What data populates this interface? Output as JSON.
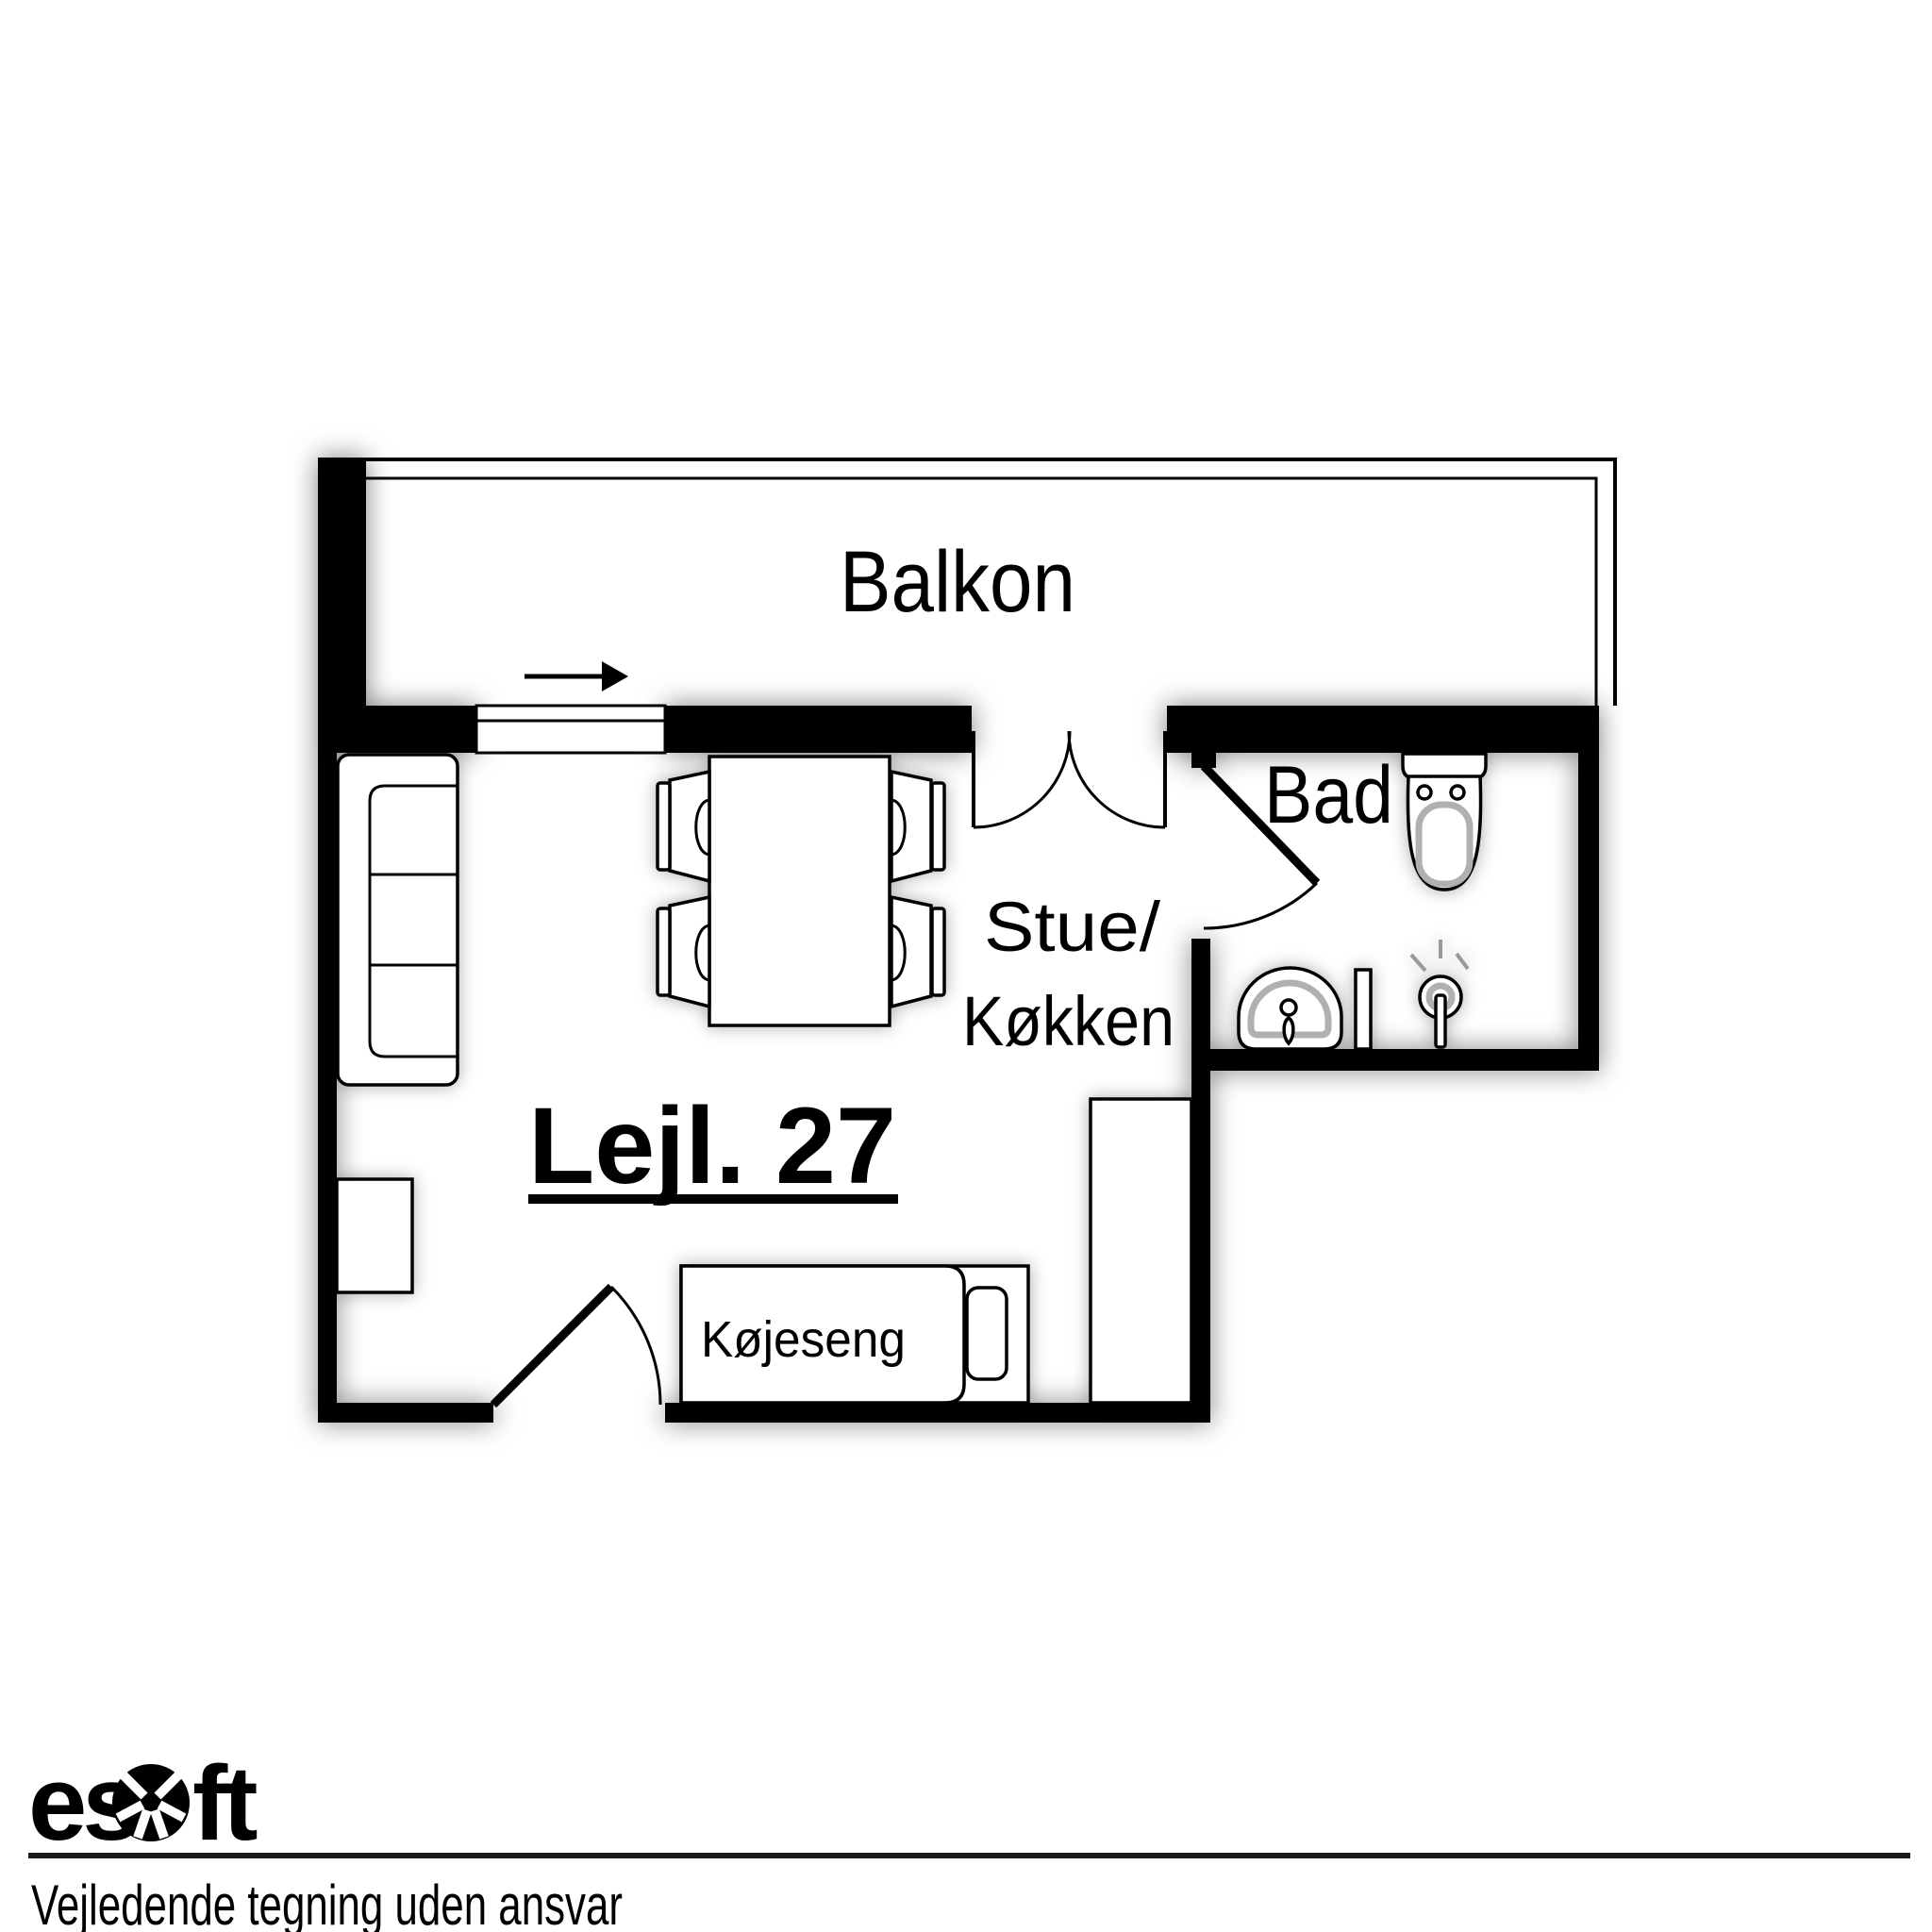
{
  "plan": {
    "apartment_label": "Lejl. 27",
    "balcony_label": "Balkon",
    "living_kitchen_label_line1": "Stue/",
    "living_kitchen_label_line2": "Køkken",
    "bathroom_label": "Bad",
    "bunk_bed_label": "Køjeseng"
  },
  "footer": {
    "brand_prefix": "es",
    "brand_suffix": "ft",
    "disclaimer": "Vejledende tegning uden ansvar"
  },
  "colors": {
    "wall": "#000000",
    "background": "#ffffff",
    "fixture_accent_gray": "#b0b0b0"
  }
}
